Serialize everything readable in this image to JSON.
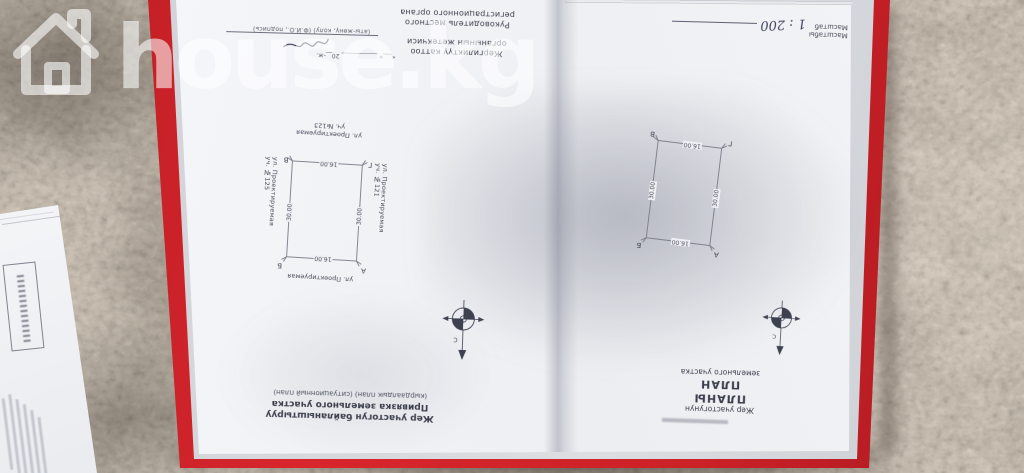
{
  "watermark": {
    "text": "house.kg"
  },
  "left_page": {
    "approval": {
      "ky_line1": "Жергиликтүү каттоо",
      "ky_line2": "органынын жетекчиси",
      "ru_line1": "Руководитель местного",
      "ru_line2": "регистрационного органа",
      "sign_caption": "(аты-жөнү, колу) (Ф.И.О., подпись)",
      "date_caption": "«___» ____________ 20__-ж."
    },
    "plan": {
      "street_top": "ул. Проектируемая",
      "street_bottom": "ул. Проектируемая",
      "plot_bottom": "уч. №123",
      "street_left": "ул. Проектируемая",
      "plot_left": "уч. №121",
      "street_right": "ул. Проектируемая",
      "plot_right": "уч. №125",
      "dim_top": "16.00",
      "dim_bottom": "16.00",
      "dim_left": "30.00",
      "dim_right": "30.00",
      "corner_tl": "А",
      "corner_tr": "Б",
      "corner_br": "В",
      "corner_bl": "Г"
    },
    "compass_label": "С",
    "title": {
      "line1": "Жер участогун байланыштыруу",
      "line2": "Привязка земельного участка",
      "line3": "(кырдаалдык план) (ситуационный план)"
    }
  },
  "right_page": {
    "scale": {
      "label_ky": "Масштабы",
      "label_ru": "Масштаб",
      "value": "1 : 200"
    },
    "plan": {
      "dim_top": "16.00",
      "dim_bottom": "16.00",
      "dim_left": "30.00",
      "dim_right": "30.00",
      "corner_tl": "А",
      "corner_tr": "Б",
      "corner_br": "В",
      "corner_bl": "Г"
    },
    "compass_label": "С",
    "title": {
      "line1": "Жер участогунун",
      "line2": "ПЛАНЫ",
      "line3": "ПЛАН",
      "line4": "земельного участка"
    }
  }
}
